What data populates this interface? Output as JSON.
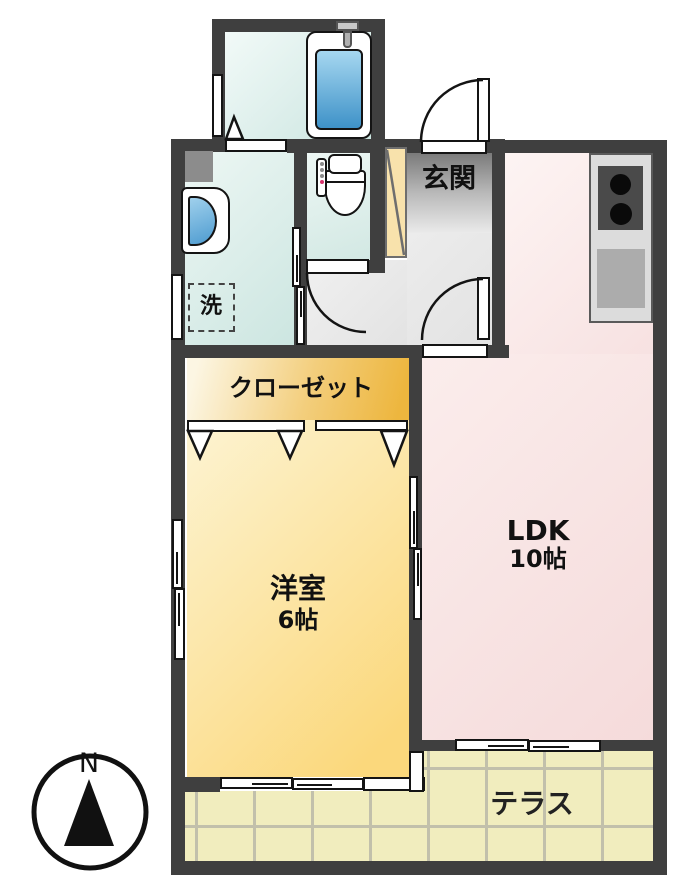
{
  "rooms": {
    "entrance": {
      "label": "玄関"
    },
    "closet": {
      "label": "クローゼット"
    },
    "western_room": {
      "name": "洋室",
      "size": "6帖"
    },
    "ldk": {
      "name": "LDK",
      "size": "10帖"
    },
    "terrace": {
      "label": "テラス"
    },
    "laundry_space": {
      "label": "洗"
    }
  },
  "compass": {
    "north_label": "N"
  },
  "colors": {
    "wall": "#3F3F3F",
    "wet_area_cyan": "#CBE5E0",
    "entrance_gray": "#7A7A7A",
    "ldk_pink": "#F5DBDB",
    "closet_orange": "#EDB63E",
    "western_room_yellow": "#FBD87C",
    "terrace_tile": "#F1EDBE",
    "bathtub_water": "#4D9BD0",
    "shoe_cabinet_tan": "#F8E2AC"
  }
}
